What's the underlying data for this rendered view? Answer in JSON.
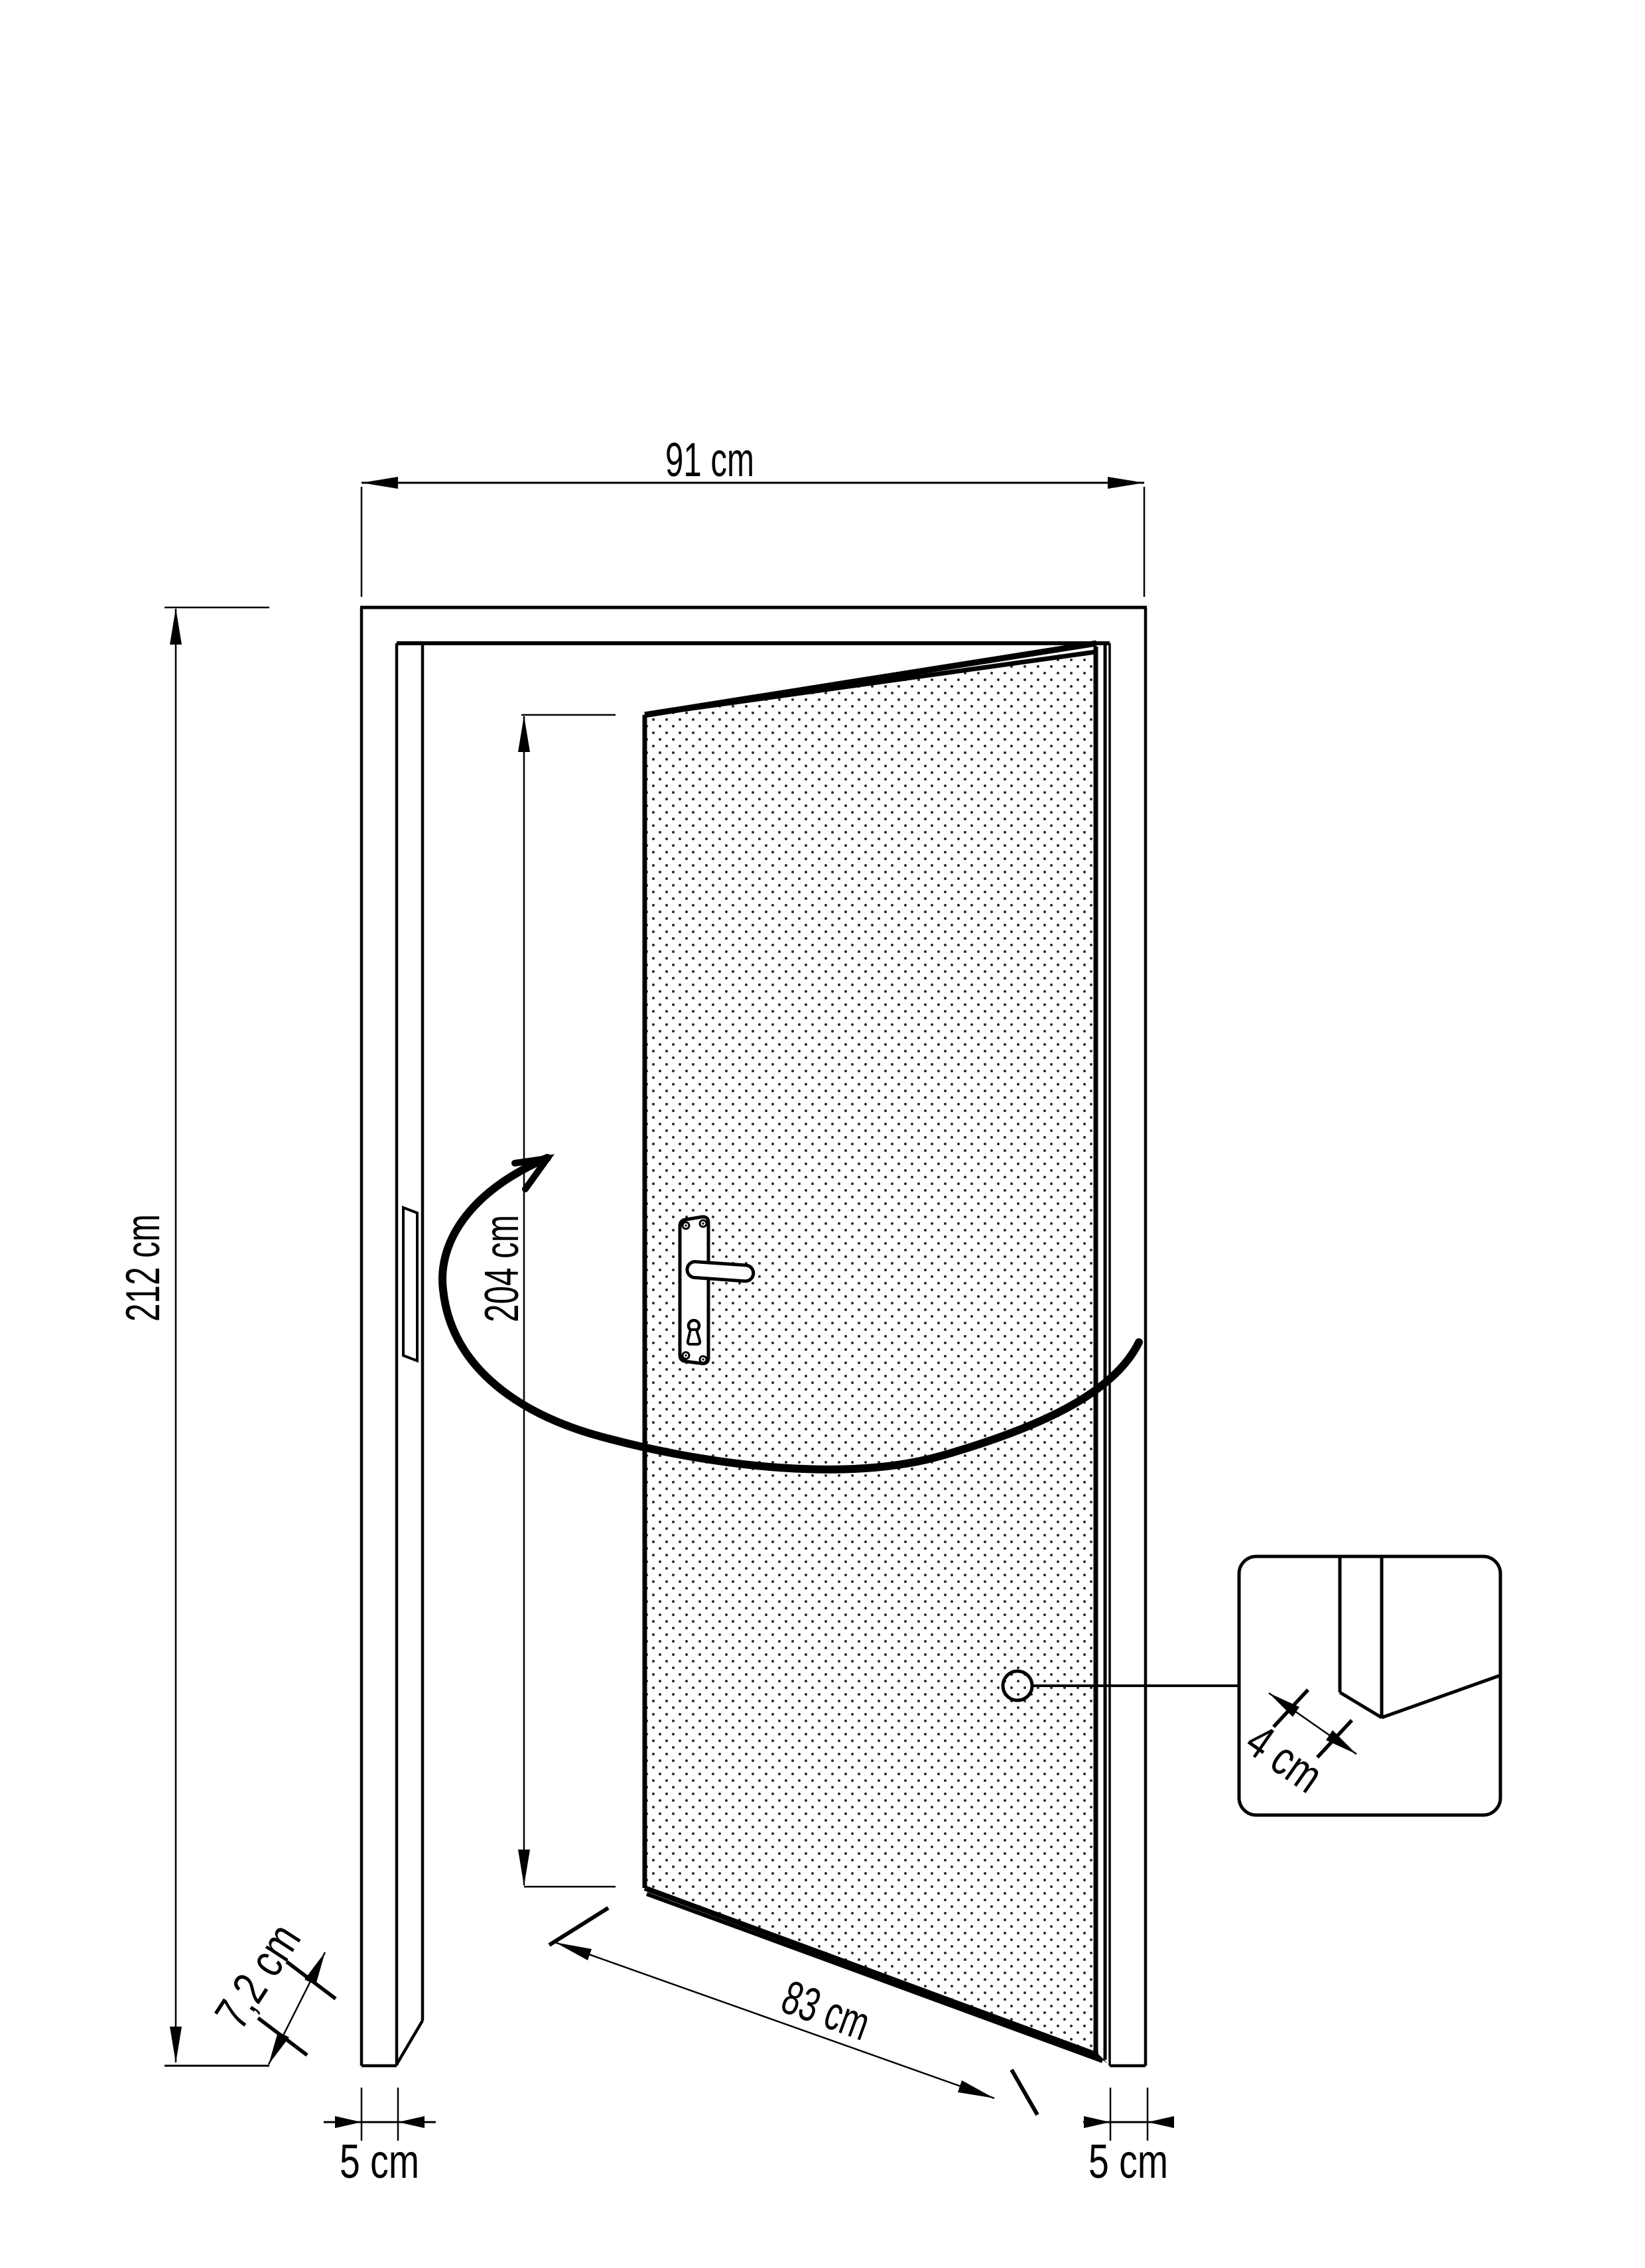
{
  "document": {
    "type": "door-installation-technical-drawing",
    "background_color": "#ffffff",
    "ink_color": "#000000",
    "texture_dot_color": "#2b2b2b"
  },
  "diagram": {
    "subject": "open door with frame, swing arc, corner detail callout",
    "labels": {
      "frame_width": "91 cm",
      "frame_height": "212 cm",
      "door_height": "204 cm",
      "door_width": "83 cm",
      "jamb_left_width": "5 cm",
      "jamb_right_width": "5 cm",
      "frame_depth": "7,2 cm",
      "door_thickness": "4 cm"
    },
    "icons": [
      "swing-direction-arrow",
      "detail-callout-circle",
      "lever-handle-icon",
      "keyhole-icon",
      "strike-plate"
    ]
  }
}
